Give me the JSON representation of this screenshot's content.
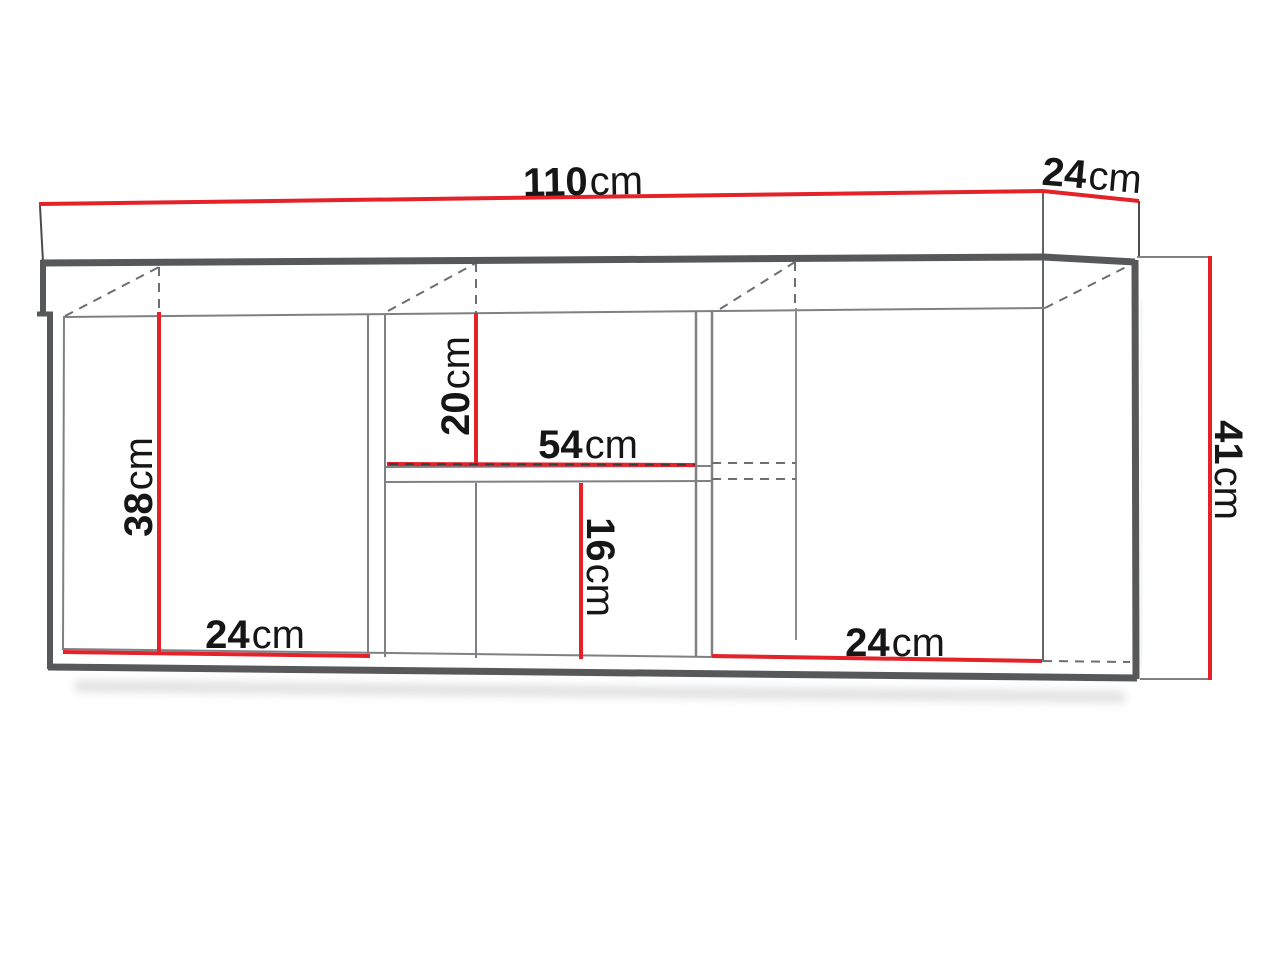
{
  "page": {
    "background": "#ffffff",
    "description": "technical dimension drawing of a wall-mounted cabinet"
  },
  "palette": {
    "dimension_red": "#e3222a",
    "outline_gray": "#57585a",
    "thin_gray": "#7e8083",
    "dashed_gray": "#6d6e71",
    "label_black": "#161616"
  },
  "dimensions": {
    "top_width": {
      "value": "110",
      "unit": "cm"
    },
    "top_depth": {
      "value": "24",
      "unit": "cm"
    },
    "side_height": {
      "value": "41",
      "unit": "cm"
    },
    "left_opening_height": {
      "value": "38",
      "unit": "cm"
    },
    "middle_upper_opening_height": {
      "value": "20",
      "unit": "cm"
    },
    "middle_shelf_width": {
      "value": "54",
      "unit": "cm"
    },
    "middle_lower_opening_height": {
      "value": "16",
      "unit": "cm"
    },
    "bottom_left_opening_width": {
      "value": "24",
      "unit": "cm"
    },
    "bottom_right_opening_width": {
      "value": "24",
      "unit": "cm"
    }
  }
}
